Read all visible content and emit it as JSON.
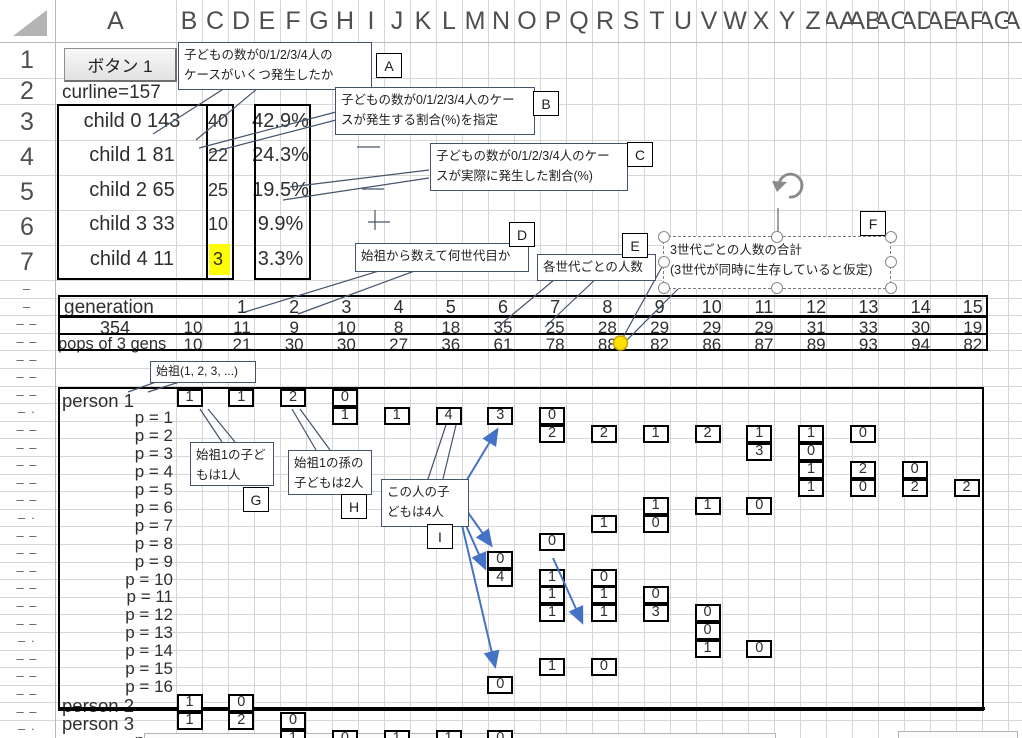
{
  "headers": {
    "columns": [
      "A",
      "B",
      "C",
      "D",
      "E",
      "F",
      "G",
      "H",
      "I",
      "J",
      "K",
      "L",
      "M",
      "N",
      "O",
      "P",
      "Q",
      "R",
      "S",
      "T",
      "U",
      "V",
      "W",
      "X",
      "Y",
      "Z",
      "AA",
      "AB",
      "AC",
      "AD",
      "AE",
      "AF",
      "AG",
      "AH"
    ],
    "rows": [
      "1",
      "2",
      "3",
      "4",
      "5",
      "6",
      "7"
    ],
    "row_dashes": [
      "–",
      "–",
      "– –",
      "– –",
      "– –",
      "– –",
      "– –",
      "– ·",
      "– –",
      "– –",
      "– –",
      "– –",
      "– –",
      "– ·",
      "– –",
      "– –",
      "– –",
      "– –",
      "– –",
      "– –",
      "– ·",
      "– –",
      "– –",
      "– –",
      "– –",
      "– ·"
    ]
  },
  "toolbar": {
    "button1_label": "ボタン 1"
  },
  "status": {
    "curline": "curline=157"
  },
  "child_table": {
    "rows": [
      {
        "label": "child 0 143",
        "count": "40",
        "pct": "42.9%",
        "highlight": false
      },
      {
        "label": "child 1 81",
        "count": "22",
        "pct": "24.3%",
        "highlight": false
      },
      {
        "label": "child 2 65",
        "count": "25",
        "pct": "19.5%",
        "highlight": false
      },
      {
        "label": "child 3 33",
        "count": "10",
        "pct": "9.9%",
        "highlight": false
      },
      {
        "label": "child 4 11",
        "count": "3",
        "pct": "3.3%",
        "highlight": true
      }
    ],
    "highlight_color": "#ffff00"
  },
  "generation_table": {
    "row1_label": "generation",
    "row2_label": "354",
    "row3_label": "pops of 3 gens",
    "generations": [
      "1",
      "2",
      "3",
      "4",
      "5",
      "6",
      "7",
      "8",
      "9",
      "10",
      "11",
      "12",
      "13",
      "14",
      "15"
    ],
    "pre_count": "10",
    "pre_pop": "10",
    "counts": [
      "11",
      "9",
      "10",
      "8",
      "18",
      "35",
      "25",
      "28",
      "29",
      "29",
      "29",
      "31",
      "33",
      "30",
      "19"
    ],
    "pops": [
      "21",
      "30",
      "30",
      "27",
      "36",
      "61",
      "78",
      "88",
      "82",
      "86",
      "87",
      "89",
      "93",
      "94",
      "82"
    ],
    "marker": {
      "name": "yellow-connector-dot",
      "color": "#ffe000",
      "at_pop_value": "88"
    }
  },
  "callouts": {
    "a": {
      "label": "A",
      "line1": "子どもの数が0/1/2/3/4人の",
      "line2": "ケースがいくつ発生したか"
    },
    "b": {
      "label": "B",
      "line1": "子どもの数が0/1/2/3/4人のケー",
      "line2": "スが発生する割合(%)を指定"
    },
    "c": {
      "label": "C",
      "line1": "子どもの数が0/1/2/3/4人のケー",
      "line2": "スが実際に発生した割合(%)"
    },
    "d": {
      "label": "D",
      "line1": "始祖から数えて何世代目か"
    },
    "e": {
      "label": "E",
      "line1": "各世代ごとの人数"
    },
    "f": {
      "label": "F",
      "line1": "3世代ごとの人数の合計",
      "line2": "(3世代が同時に生存していると仮定)",
      "selected": true,
      "rotate_icon": "circular-arrow"
    },
    "origin": {
      "text": "始祖(1, 2, 3, ...)"
    },
    "g": {
      "label": "G",
      "line1": "始祖1の子ど",
      "line2": "もは1人"
    },
    "h": {
      "label": "H",
      "line1": "始祖1の孫の",
      "line2": "子どもは2人"
    },
    "i": {
      "label": "I",
      "line1": "この人の子",
      "line2": "どもは4人"
    }
  },
  "tree": {
    "rows": [
      {
        "label": "person 1",
        "boxes": [
          {
            "c": 0,
            "v": "1"
          },
          {
            "c": 2,
            "v": "1"
          },
          {
            "c": 4,
            "v": "2"
          },
          {
            "c": 6,
            "v": "0"
          }
        ]
      },
      {
        "label": "p = 1",
        "boxes": [
          {
            "c": 6,
            "v": "1"
          },
          {
            "c": 8,
            "v": "1"
          },
          {
            "c": 10,
            "v": "4"
          },
          {
            "c": 12,
            "v": "3"
          },
          {
            "c": 14,
            "v": "0"
          }
        ]
      },
      {
        "label": "p = 2",
        "boxes": [
          {
            "c": 14,
            "v": "2"
          },
          {
            "c": 16,
            "v": "2"
          },
          {
            "c": 18,
            "v": "1"
          },
          {
            "c": 20,
            "v": "2"
          },
          {
            "c": 22,
            "v": "1"
          },
          {
            "c": 24,
            "v": "1"
          },
          {
            "c": 26,
            "v": "0"
          }
        ]
      },
      {
        "label": "p = 3",
        "boxes": [
          {
            "c": 22,
            "v": "3"
          },
          {
            "c": 24,
            "v": "0"
          }
        ]
      },
      {
        "label": "p = 4",
        "boxes": [
          {
            "c": 24,
            "v": "1"
          },
          {
            "c": 26,
            "v": "2"
          },
          {
            "c": 28,
            "v": "0"
          }
        ]
      },
      {
        "label": "p = 5",
        "boxes": [
          {
            "c": 24,
            "v": "1"
          },
          {
            "c": 26,
            "v": "0"
          },
          {
            "c": 28,
            "v": "2"
          },
          {
            "c": 30,
            "v": "2"
          }
        ]
      },
      {
        "label": "p = 6",
        "boxes": [
          {
            "c": 18,
            "v": "1"
          },
          {
            "c": 20,
            "v": "1"
          },
          {
            "c": 22,
            "v": "0"
          }
        ]
      },
      {
        "label": "p = 7",
        "boxes": [
          {
            "c": 16,
            "v": "1"
          },
          {
            "c": 18,
            "v": "0"
          }
        ]
      },
      {
        "label": "p = 8",
        "boxes": [
          {
            "c": 14,
            "v": "0"
          }
        ]
      },
      {
        "label": "p = 9",
        "boxes": [
          {
            "c": 12,
            "v": "0"
          }
        ]
      },
      {
        "label": "p = 10",
        "boxes": [
          {
            "c": 12,
            "v": "4"
          },
          {
            "c": 14,
            "v": "1"
          },
          {
            "c": 16,
            "v": "0"
          }
        ]
      },
      {
        "label": "p = 11",
        "boxes": [
          {
            "c": 14,
            "v": "1"
          },
          {
            "c": 16,
            "v": "1"
          },
          {
            "c": 18,
            "v": "0"
          }
        ]
      },
      {
        "label": "p = 12",
        "boxes": [
          {
            "c": 14,
            "v": "1"
          },
          {
            "c": 16,
            "v": "1"
          },
          {
            "c": 18,
            "v": "3"
          },
          {
            "c": 20,
            "v": "0"
          }
        ]
      },
      {
        "label": "p = 13",
        "boxes": [
          {
            "c": 20,
            "v": "0"
          }
        ]
      },
      {
        "label": "p = 14",
        "boxes": [
          {
            "c": 20,
            "v": "1"
          },
          {
            "c": 22,
            "v": "0"
          }
        ]
      },
      {
        "label": "p = 15",
        "boxes": [
          {
            "c": 14,
            "v": "1"
          },
          {
            "c": 16,
            "v": "0"
          }
        ]
      },
      {
        "label": "p = 16",
        "boxes": [
          {
            "c": 12,
            "v": "0"
          }
        ]
      },
      {
        "label": "person 2",
        "boxes": [
          {
            "c": 0,
            "v": "1"
          },
          {
            "c": 2,
            "v": "0"
          }
        ]
      },
      {
        "label": "person 3",
        "boxes": [
          {
            "c": 0,
            "v": "1"
          },
          {
            "c": 2,
            "v": "2"
          },
          {
            "c": 4,
            "v": "0"
          }
        ]
      },
      {
        "label": "p = 1",
        "boxes": [
          {
            "c": 4,
            "v": "1"
          },
          {
            "c": 6,
            "v": "0"
          },
          {
            "c": 8,
            "v": "1"
          },
          {
            "c": 10,
            "v": "1"
          },
          {
            "c": 12,
            "v": "0"
          }
        ]
      }
    ]
  },
  "colors": {
    "grid": "#d6d6d6",
    "connector_blue": "#6f8ab8",
    "arrow_blue": "#4472c4",
    "leader": "#44546a",
    "highlight_yellow": "#ffff00"
  }
}
